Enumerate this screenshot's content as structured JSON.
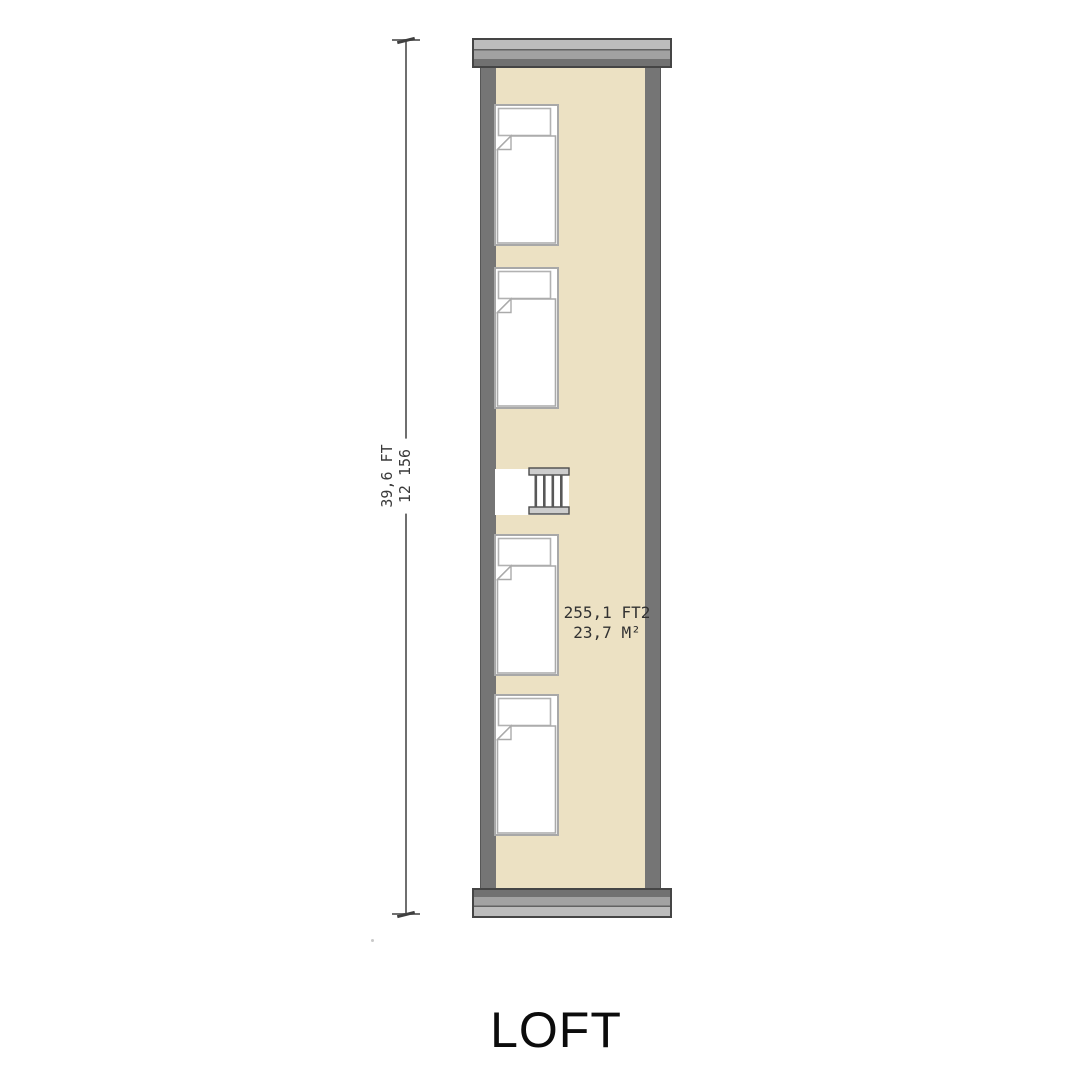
{
  "title": "LOFT",
  "dimension": {
    "feet": "39,6 FT",
    "millimeters": "12 156"
  },
  "area": {
    "imperial": "255,1 FT2",
    "metric": "23,7 M²"
  },
  "colors": {
    "floor": "#ECE1C3",
    "wall": "#757575",
    "cap_light": "#BCBCBC",
    "cap_mid": "#A2A2A2",
    "cap_dark": "#717171",
    "bed_outline": "#A8A8A8",
    "ladder_rail": "#CDCDCD",
    "ladder_bar": "#585858",
    "annotation_text": "#3A3A3A",
    "title_text": "#0C0C0C"
  }
}
